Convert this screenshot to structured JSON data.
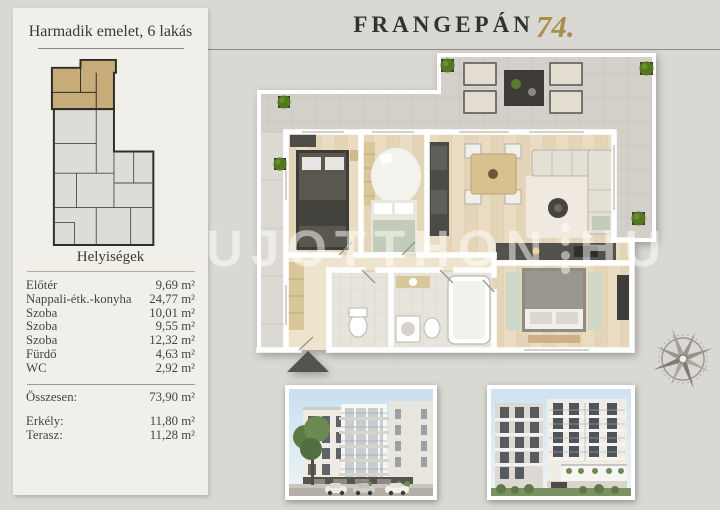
{
  "header": {
    "brand": "FRANGEPÁN",
    "number": "74."
  },
  "sidebar": {
    "title": "Harmadik emelet, 6 lakás",
    "section_title": "Helyiségek",
    "rooms": [
      {
        "name": "Előtér",
        "area": "9,69 m²"
      },
      {
        "name": "Nappali-étk.-konyha",
        "area": "24,77 m²"
      },
      {
        "name": "Szoba",
        "area": "10,01 m²"
      },
      {
        "name": "Szoba",
        "area": "9,55 m²"
      },
      {
        "name": "Szoba",
        "area": "12,32 m²"
      },
      {
        "name": "Fürdő",
        "area": "4,63 m²"
      },
      {
        "name": "WC",
        "area": "2,92 m²"
      }
    ],
    "totals": [
      {
        "name": "Összesen:",
        "area": "73,90 m²"
      },
      {
        "name": "Erkély:",
        "area": "11,80 m²"
      },
      {
        "name": "Terasz:",
        "area": "11,28 m²"
      }
    ]
  },
  "watermark": {
    "left": "UJOTTHON",
    "right": "HU"
  },
  "colors": {
    "background": "#d9d8d3",
    "panel": "#f0efea",
    "accent_gold": "#ad8d4b",
    "tan_highlight": "#c7ab79",
    "ink": "#33322e"
  }
}
